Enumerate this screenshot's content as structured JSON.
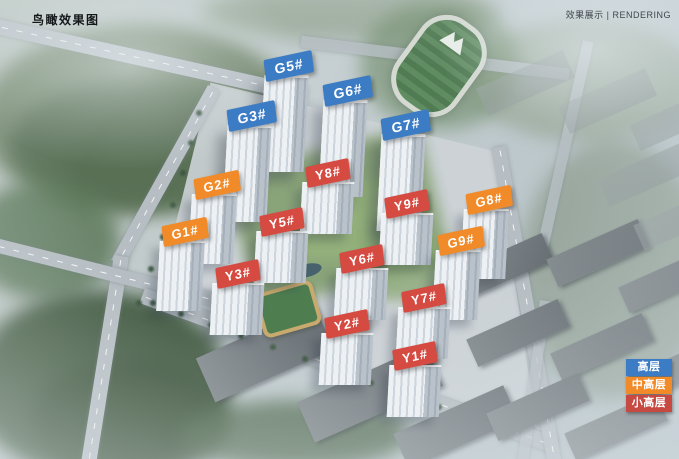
{
  "header": {
    "left_title": "鸟瞰效果图",
    "right_title": "效果展示 | RENDERING"
  },
  "legend": {
    "items": [
      {
        "label": "高层",
        "color": "#3c7cc4"
      },
      {
        "label": "中高层",
        "color": "#f18a28"
      },
      {
        "label": "小高层",
        "color": "#c64a41"
      }
    ]
  },
  "categories": {
    "高层": {
      "color": "#3c7cc4"
    },
    "中高层": {
      "color": "#f18a28"
    },
    "小高层": {
      "color": "#d64b41"
    }
  },
  "buildings": [
    {
      "name": "G5#",
      "category": "高层",
      "x": 289,
      "y": 66
    },
    {
      "name": "G6#",
      "category": "高层",
      "x": 348,
      "y": 91
    },
    {
      "name": "G3#",
      "category": "高层",
      "x": 252,
      "y": 116
    },
    {
      "name": "G7#",
      "category": "高层",
      "x": 406,
      "y": 125
    },
    {
      "name": "Y8#",
      "category": "小高层",
      "x": 328,
      "y": 173
    },
    {
      "name": "G2#",
      "category": "中高层",
      "x": 217,
      "y": 185
    },
    {
      "name": "G8#",
      "category": "中高层",
      "x": 489,
      "y": 200
    },
    {
      "name": "Y9#",
      "category": "小高层",
      "x": 407,
      "y": 204
    },
    {
      "name": "Y5#",
      "category": "小高层",
      "x": 282,
      "y": 222
    },
    {
      "name": "G1#",
      "category": "中高层",
      "x": 185,
      "y": 232
    },
    {
      "name": "G9#",
      "category": "中高层",
      "x": 461,
      "y": 241
    },
    {
      "name": "Y6#",
      "category": "小高层",
      "x": 362,
      "y": 259
    },
    {
      "name": "Y3#",
      "category": "小高层",
      "x": 238,
      "y": 274
    },
    {
      "name": "Y7#",
      "category": "小高层",
      "x": 424,
      "y": 298
    },
    {
      "name": "Y2#",
      "category": "小高层",
      "x": 347,
      "y": 324
    },
    {
      "name": "Y1#",
      "category": "小高层",
      "x": 415,
      "y": 356
    }
  ]
}
